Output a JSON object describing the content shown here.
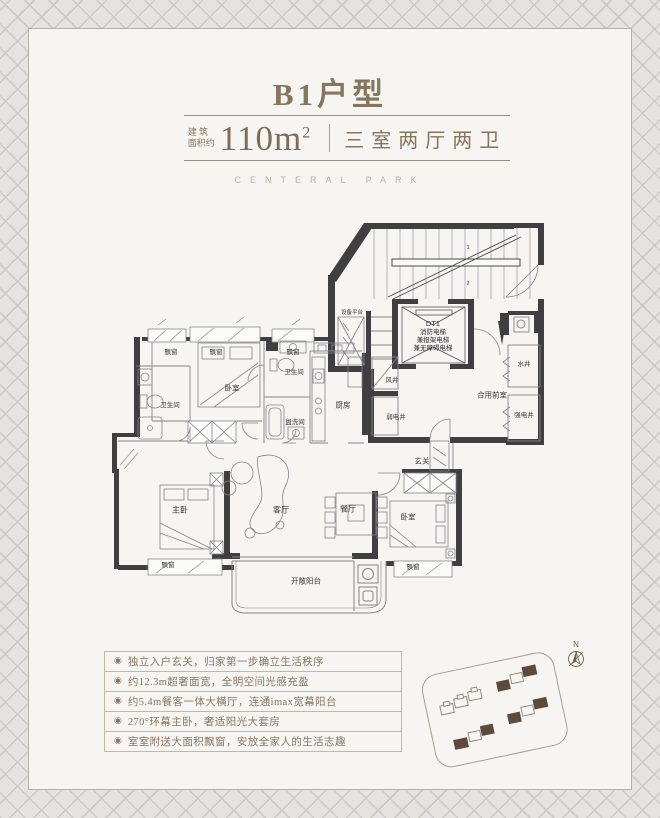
{
  "header": {
    "title": "B1户型",
    "area_prefix_line1": "建 筑",
    "area_prefix_line2": "面积约",
    "area_value": "110m",
    "area_sup": "2",
    "layout_text": "三室两厅两卫",
    "watermark": "CENTERAL PARK"
  },
  "floorplan": {
    "elevator": {
      "line1": "DT1",
      "line2": "消防电梯",
      "line3": "兼担架电梯",
      "line4": "兼无障碍电梯"
    },
    "labels": [
      {
        "id": "equipment-platform",
        "text": "设备平台"
      },
      {
        "id": "water-shaft",
        "text": "水井"
      },
      {
        "id": "strong-current-shaft",
        "text": "强电井"
      },
      {
        "id": "shared-vestibule",
        "text": "合用前室"
      },
      {
        "id": "air-shaft",
        "text": "风井"
      },
      {
        "id": "weak-current-shaft",
        "text": "弱电井"
      },
      {
        "id": "kitchen",
        "text": "厨房"
      },
      {
        "id": "entry-hall",
        "text": "玄关"
      },
      {
        "id": "bay-window-1",
        "text": "飘窗"
      },
      {
        "id": "bay-window-2",
        "text": "飘窗"
      },
      {
        "id": "bay-window-3",
        "text": "飘窗"
      },
      {
        "id": "bedroom-left",
        "text": "卧室"
      },
      {
        "id": "bathroom-left",
        "text": "卫生间"
      },
      {
        "id": "bathroom-mid",
        "text": "卫生间"
      },
      {
        "id": "washroom",
        "text": "盥洗间"
      },
      {
        "id": "master-bedroom",
        "text": "主卧"
      },
      {
        "id": "living-room",
        "text": "客厅"
      },
      {
        "id": "dining-room",
        "text": "餐厅"
      },
      {
        "id": "bedroom-right",
        "text": "卧室"
      },
      {
        "id": "bay-window-4",
        "text": "飘窗"
      },
      {
        "id": "bay-window-5",
        "text": "飘窗"
      },
      {
        "id": "open-balcony",
        "text": "开敞阳台"
      },
      {
        "id": "stair-marker-1",
        "text": "1"
      },
      {
        "id": "stair-marker-2",
        "text": "2"
      }
    ]
  },
  "features": {
    "bullet": "◉",
    "items": [
      "独立入户玄关，归家第一步确立生活秩序",
      "约12.3m超奢面宽，全明空间光感充盈",
      "约5.4m餐客一体大横厅，连通imax宽幕阳台",
      "270°环幕主卧，奢适阳光大套房",
      "室室附送大面积飘窗，安放全家人的生活志趣"
    ]
  },
  "siteplan": {
    "north_label": "N"
  },
  "colors": {
    "accent_brown": "#86755f",
    "wall_dark": "#3f3e41",
    "feature_border": "#c9b49e",
    "site_building_dark": "#5d4a3a",
    "card_bg": "#f6f5f2",
    "page_bg": "#e4e3e1"
  }
}
